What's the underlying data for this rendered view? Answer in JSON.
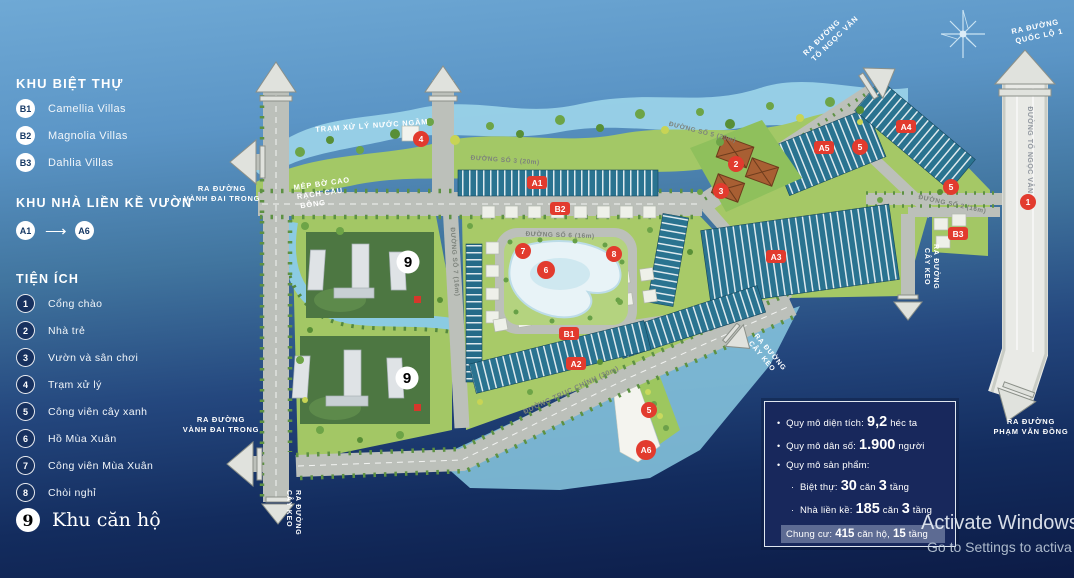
{
  "legend": {
    "villas_title": "KHU BIỆT THỰ",
    "villas": [
      {
        "code": "B1",
        "label": "Camellia Villas"
      },
      {
        "code": "B2",
        "label": "Magnolia Villas"
      },
      {
        "code": "B3",
        "label": "Dahlia Villas"
      }
    ],
    "townhouse_title": "KHU NHÀ LIỀN KỀ VƯỜN",
    "range_from": "A1",
    "range_to": "A6",
    "amenities_title": "TIỆN ÍCH",
    "amenities": [
      {
        "num": "1",
        "label": "Cổng chào"
      },
      {
        "num": "2",
        "label": "Nhà trẻ"
      },
      {
        "num": "3",
        "label": "Vườn và sân chơi"
      },
      {
        "num": "4",
        "label": "Trạm xử lý"
      },
      {
        "num": "5",
        "label": "Công viên cây xanh"
      },
      {
        "num": "6",
        "label": "Hồ Mùa Xuân"
      },
      {
        "num": "7",
        "label": "Công viên Mùa Xuân"
      },
      {
        "num": "8",
        "label": "Chòi nghỉ"
      }
    ],
    "apartment": {
      "num": "9",
      "label": "Khu căn hộ"
    }
  },
  "map": {
    "labels": {
      "tram": "TRẠM XỬ LÝ NƯỚC NGẦM",
      "mep1": "MÉP BỜ CAO",
      "mep2": "RẠCH CẦU",
      "mep3": "BÔNG"
    },
    "exits": {
      "ra": "RA ĐƯỜNG",
      "vanh": "VÀNH ĐAI TRONG",
      "caykeo": "CÂY KEO",
      "tnv": "TỐ NGỌC VÂN",
      "ql1": "QUỐC LỘ 1",
      "pvd": "PHẠM VĂN ĐỒNG"
    },
    "roads": {
      "so3": "ĐƯỜNG SỐ 3 (20m)",
      "so5": "ĐƯỜNG SỐ 5 (20m)",
      "so6": "ĐƯỜNG SỐ 6 (16m)",
      "so7": "ĐƯỜNG SỐ 7 (16m)",
      "so2": "ĐƯỜNG SỐ 2 (16m)",
      "truc": "ĐƯỜNG TRỤC CHÍNH (30m)",
      "tnv_street": "ĐƯỜNG TỐ NGỌC VÂN"
    },
    "badges": [
      "A1",
      "B2",
      "B1",
      "A2",
      "A3",
      "A4",
      "A5",
      "B3",
      "A6"
    ],
    "markers": [
      "4",
      "2",
      "3",
      "5",
      "5",
      "1",
      "7",
      "6",
      "8",
      "5"
    ],
    "nine": "9",
    "colors": {
      "accent_red": "#E23B2E",
      "road_gray": "#BCC0BA",
      "land_green": "#A6C966",
      "water_blue": "#9AD2E8",
      "rowhouse_teal": "#2A7390",
      "navy": "#16305F"
    }
  },
  "infobox": {
    "row1": {
      "pre": "Quy mô diện tích:",
      "big": "9,2",
      "post": "héc ta"
    },
    "row2": {
      "pre": "Quy mô dân số:",
      "big": "1.900",
      "post": "người"
    },
    "row3": {
      "pre": "Quy mô sản phẩm:"
    },
    "sub1": {
      "pre": "Biệt thự:",
      "big1": "30",
      "mid": "căn",
      "big2": "3",
      "post": "tầng"
    },
    "sub2": {
      "pre": "Nhà liền kề:",
      "big1": "185",
      "mid": "căn",
      "big2": "3",
      "post": "tầng"
    },
    "strip": {
      "pre": "Chung cư:",
      "big1": "415",
      "mid": "căn hộ,",
      "big2": "15",
      "post": "tầng"
    }
  },
  "watermark": {
    "line1": "Activate Windows",
    "line2": "Go to Settings to activa"
  }
}
